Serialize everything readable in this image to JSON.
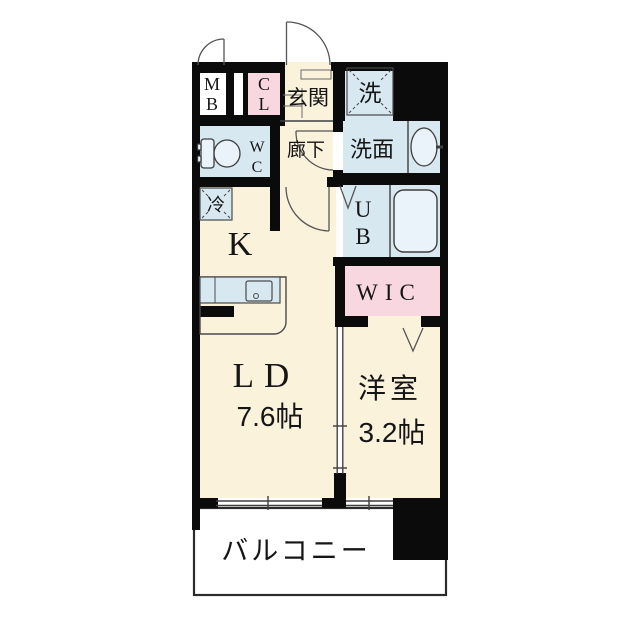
{
  "plan": {
    "type": "apartment-floor-plan",
    "colors": {
      "wall": "#0b0b0b",
      "floor": "#FBF2DC",
      "wet_area": "#D8E8F1",
      "closet_pink": "#F8D7E1",
      "fixture_fill": "#EAF3F9",
      "white": "#FFFFFF",
      "line": "#4a4a4a",
      "text": "#151515"
    },
    "labels": {
      "mb": {
        "line1": "M",
        "line2": "B"
      },
      "cl": {
        "line1": "C",
        "line2": "L"
      },
      "genkan": {
        "label": "玄関"
      },
      "laundry": {
        "label": "洗"
      },
      "wc": {
        "line1": "W",
        "line2": "C"
      },
      "hallway": {
        "label": "廊下"
      },
      "washroom": {
        "label": "洗面"
      },
      "fridge": {
        "label": "冷"
      },
      "kitchen": {
        "label": "K"
      },
      "unit_bath": {
        "line1": "U",
        "line2": "B"
      },
      "wic": {
        "label": "WIC"
      },
      "living_dining": {
        "label": "LD",
        "size": "7.6帖"
      },
      "bedroom": {
        "label": "洋室",
        "size": "3.2帖"
      },
      "balcony": {
        "label": "バルコニー"
      }
    }
  }
}
